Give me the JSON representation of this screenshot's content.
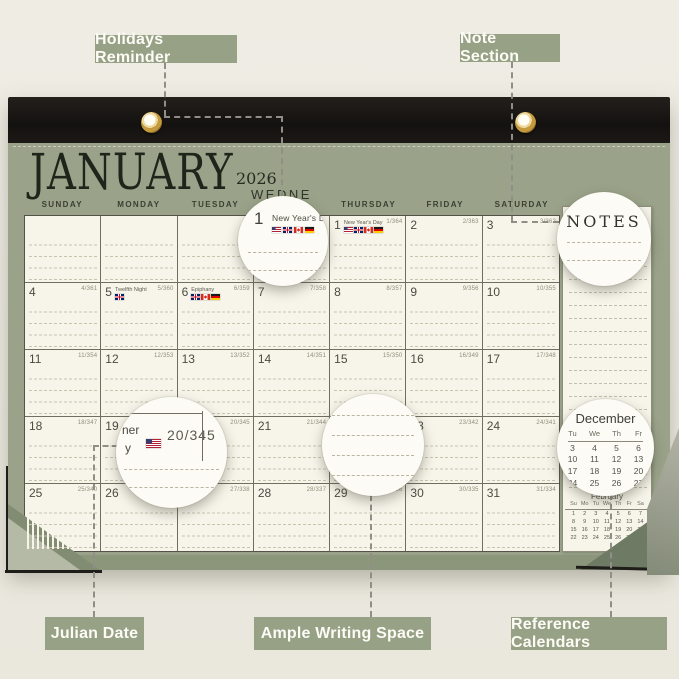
{
  "callouts": {
    "holidays_reminder": "Holidays Reminder",
    "note_section": "Note Section",
    "julian_date": "Julian Date",
    "ample_writing_space": "Ample Writing Space",
    "reference_calendars": "Reference Calendars"
  },
  "calendar": {
    "month": "JANUARY",
    "year": "2026",
    "partial_weekday": "WEDNE",
    "weekday_headers": [
      "SUNDAY",
      "MONDAY",
      "TUESDAY",
      "WEDNESDAY",
      "THURSDAY",
      "FRIDAY",
      "SATURDAY"
    ],
    "notes_label": "NOTES",
    "weeks": [
      [
        {},
        {},
        {},
        {},
        {
          "d": "1",
          "j": "1/364",
          "h": "New Year's Day",
          "f": [
            "us",
            "uk",
            "ca",
            "de"
          ]
        },
        {
          "d": "2",
          "j": "2/363"
        },
        {
          "d": "3",
          "j": "3/362"
        }
      ],
      [
        {
          "d": "4",
          "j": "4/361"
        },
        {
          "d": "5",
          "j": "5/360",
          "h": "Twelfth Night",
          "f": [
            "uk"
          ]
        },
        {
          "d": "6",
          "j": "6/359",
          "h": "Epiphany",
          "f": [
            "uk",
            "ca",
            "de"
          ]
        },
        {
          "d": "7",
          "j": "7/358"
        },
        {
          "d": "8",
          "j": "8/357"
        },
        {
          "d": "9",
          "j": "9/356"
        },
        {
          "d": "10",
          "j": "10/355"
        }
      ],
      [
        {
          "d": "11",
          "j": "11/354"
        },
        {
          "d": "12",
          "j": "12/353"
        },
        {
          "d": "13",
          "j": "13/352"
        },
        {
          "d": "14",
          "j": "14/351"
        },
        {
          "d": "15",
          "j": "15/350"
        },
        {
          "d": "16",
          "j": "16/349"
        },
        {
          "d": "17",
          "j": "17/348"
        }
      ],
      [
        {
          "d": "18",
          "j": "18/347"
        },
        {
          "d": "19"
        },
        {
          "d": "20",
          "j": "20/345"
        },
        {
          "d": "21",
          "j": "21/344"
        },
        {
          "d": "22"
        },
        {
          "d": "23",
          "j": "23/342"
        },
        {
          "d": "24",
          "j": "24/341"
        }
      ],
      [
        {
          "d": "25",
          "j": "25/340"
        },
        {
          "d": "26"
        },
        {
          "d": "27",
          "j": "27/338"
        },
        {
          "d": "28",
          "j": "28/337"
        },
        {
          "d": "29",
          "j": "29/336"
        },
        {
          "d": "30",
          "j": "30/335"
        },
        {
          "d": "31",
          "j": "31/334"
        }
      ]
    ]
  },
  "magnifiers": {
    "holiday": {
      "day": "1",
      "name": "New Year's Day",
      "flags": [
        "us",
        "uk",
        "ca",
        "de"
      ]
    },
    "julian": {
      "fragment_line1": "ner",
      "fragment_line2": "y",
      "julian": "20/345",
      "flag": "us"
    }
  },
  "reference_calendars": {
    "december": {
      "title": "December",
      "headers": [
        "Tu",
        "We",
        "Th",
        "Fr"
      ],
      "rows": [
        [
          3,
          4,
          5,
          6
        ],
        [
          10,
          11,
          12,
          13
        ],
        [
          17,
          18,
          19,
          20
        ],
        [
          24,
          25,
          26,
          27
        ]
      ]
    },
    "february": {
      "title": "February",
      "headers": [
        "Su",
        "Mo",
        "Tu",
        "We",
        "Th",
        "Fr",
        "Sa"
      ],
      "rows": [
        [
          1,
          2,
          3,
          4,
          5,
          6,
          7
        ],
        [
          8,
          9,
          10,
          11,
          12,
          13,
          14
        ],
        [
          15,
          16,
          17,
          18,
          19,
          20,
          21
        ],
        [
          22,
          23,
          24,
          25,
          26,
          27,
          28
        ]
      ]
    }
  },
  "colors": {
    "label_bg": "#96a185",
    "page_green": "#9aa389",
    "paper_cream": "#f7f5ea",
    "binding_black": "#1a1815",
    "grommet_gold": "#c49a3c"
  }
}
